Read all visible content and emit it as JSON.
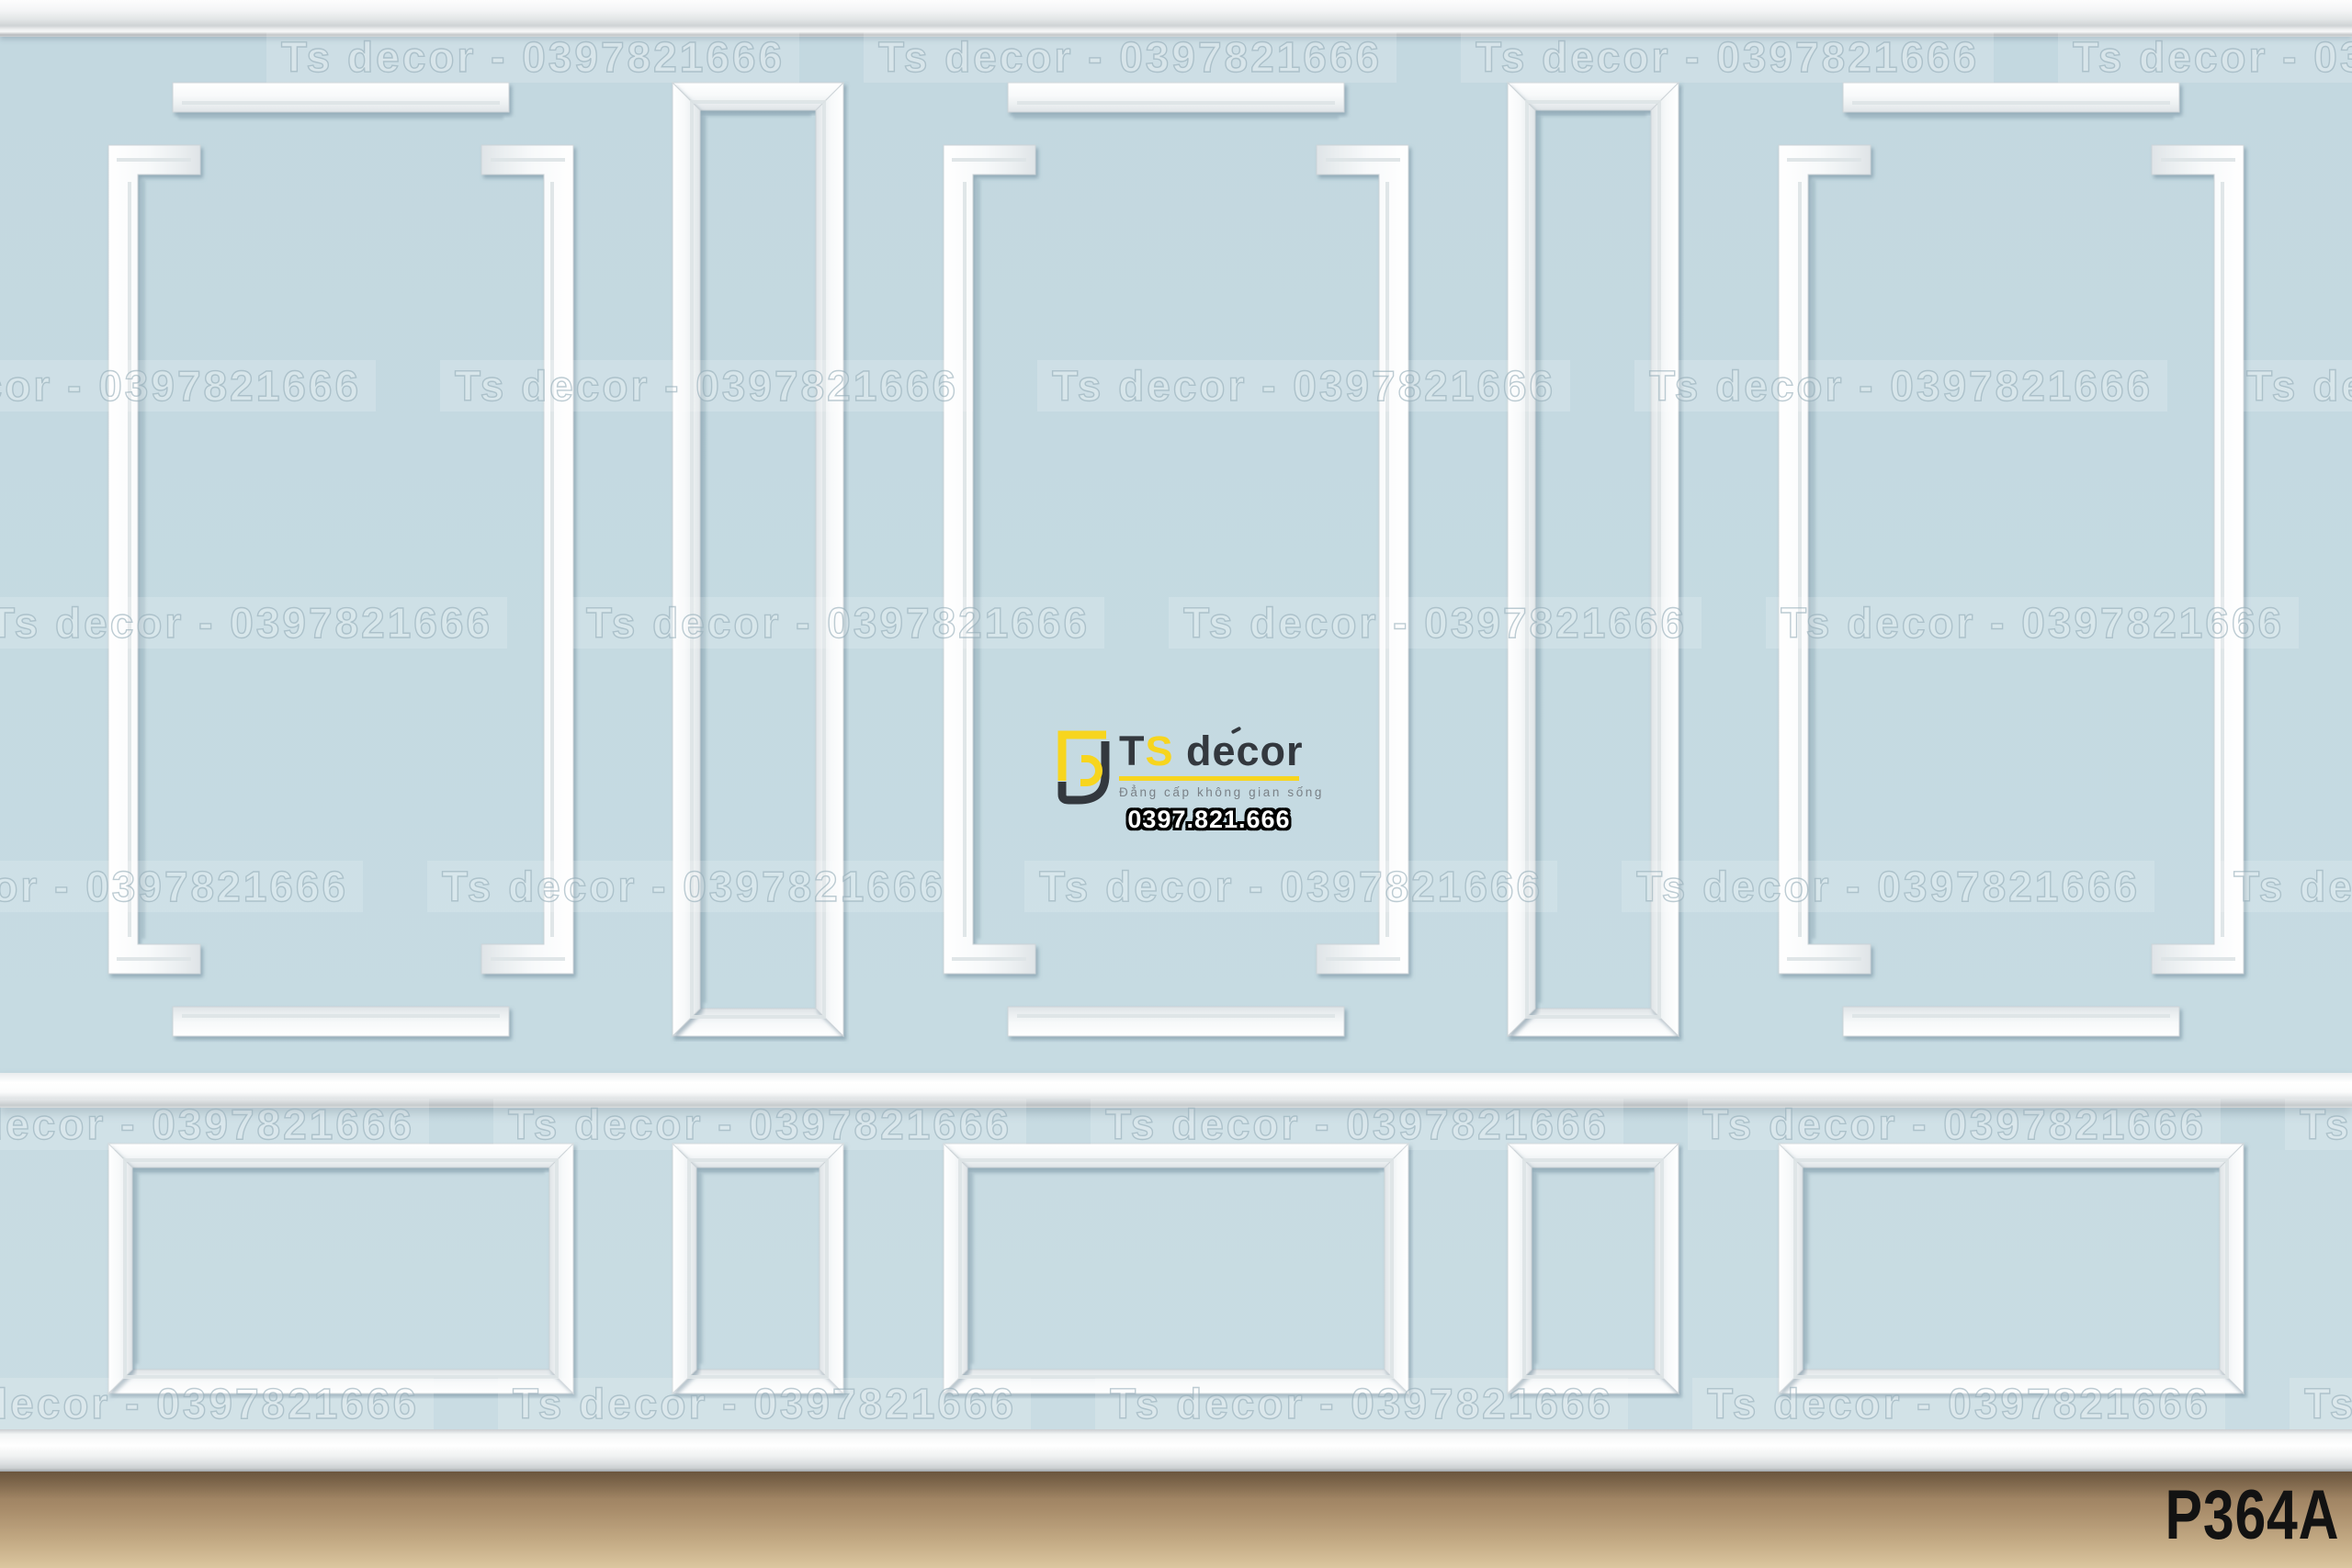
{
  "watermark": {
    "text": "Ts decor - 0397821666"
  },
  "logo": {
    "brand_t": "T",
    "brand_s": "S",
    "brand_rest": " decor",
    "tagline": "Đẳng cấp không gian sống",
    "phone": "0397.821.666"
  },
  "product_code": "P364A",
  "colors": {
    "wall-upper": "#c3d8e0",
    "wall-upper2": "#c6dbe2",
    "wall-lower": "#c7dbe2",
    "wall-lower2": "#c9dce3",
    "accent": "#f7d51e",
    "brand-dark": "#33383e",
    "tagline": "#7a8187",
    "floor-top": "#8c7355",
    "floor-bottom": "#dbc69f",
    "code": "#121212"
  }
}
